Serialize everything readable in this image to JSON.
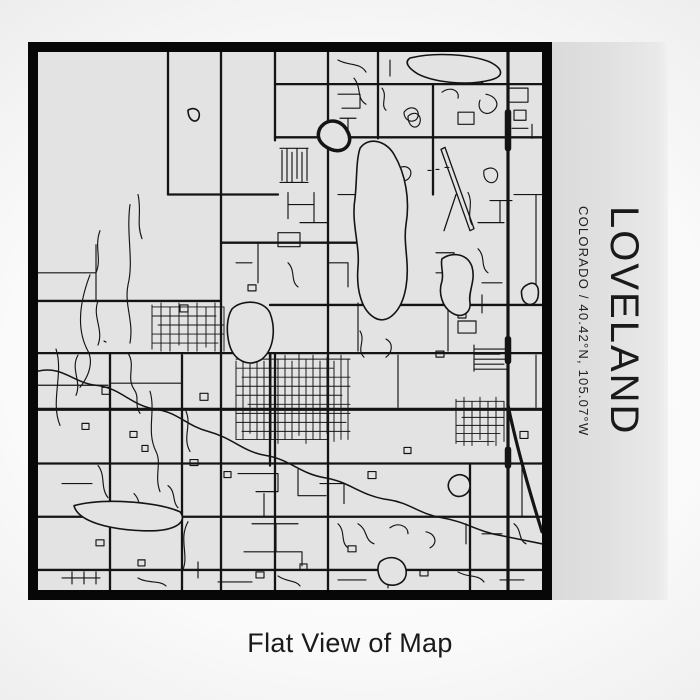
{
  "product": {
    "title": "LOVELAND",
    "subtitle": "COLORADO / 40.42°N, 105.07°W",
    "caption": "Flat View of Map"
  },
  "map": {
    "place": "Loveland",
    "region": "Colorado",
    "coordinates": "40.42°N, 105.07°W"
  },
  "style": {
    "backdrop_center": "#ffffff",
    "backdrop_edge": "#cfcfcf",
    "map_background": "#e3e3e3",
    "panel_background": "#e0e0e0",
    "road_color": "#141414",
    "frame_color": "#070707",
    "text_color": "#1a1a1a"
  }
}
